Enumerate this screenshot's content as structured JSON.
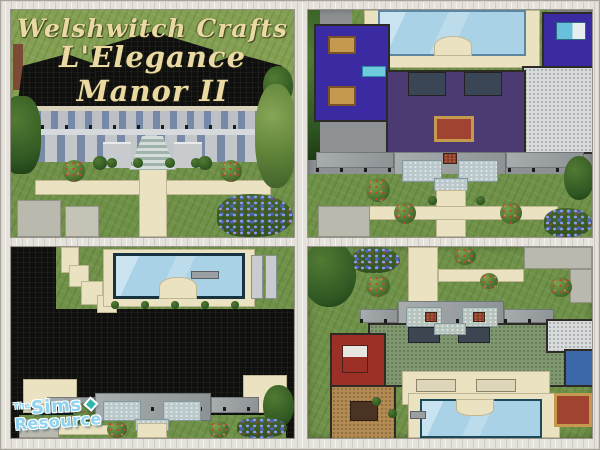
{
  "title": {
    "line1": "Welshwitch Crafts",
    "line2": "L'Elegance Manor II"
  },
  "watermark": {
    "the": "The",
    "sims": "Sims",
    "resource": "Resource"
  },
  "colors": {
    "frame": "#e5e2dc",
    "grass": "#6f9148",
    "path": "#eae2c0",
    "sidewalk": "#bab9ad",
    "roof-black": "#0f100e",
    "stone": "#bcc0c4",
    "stone-light": "#d7dadc",
    "pool-water": "#a9d2e6",
    "carpet-indigo": "#3a2ba2",
    "carpet-violet": "#4c3a72",
    "carpet-green": "#80986f",
    "room-red": "#9c3026",
    "room-tan": "#b28a52",
    "room-blue": "#3a68a8",
    "rug-red": "#a04330",
    "rug-gold": "#c59a4e",
    "awning": "#bac8cc",
    "flowers": "#4c63b8",
    "chimney": "#7d4a36",
    "white-floor": "#d8dbdc",
    "title-cream": "#ead9a2",
    "logo-blue": "#8ed4f0",
    "logo-teal": "#2fb7ad"
  }
}
